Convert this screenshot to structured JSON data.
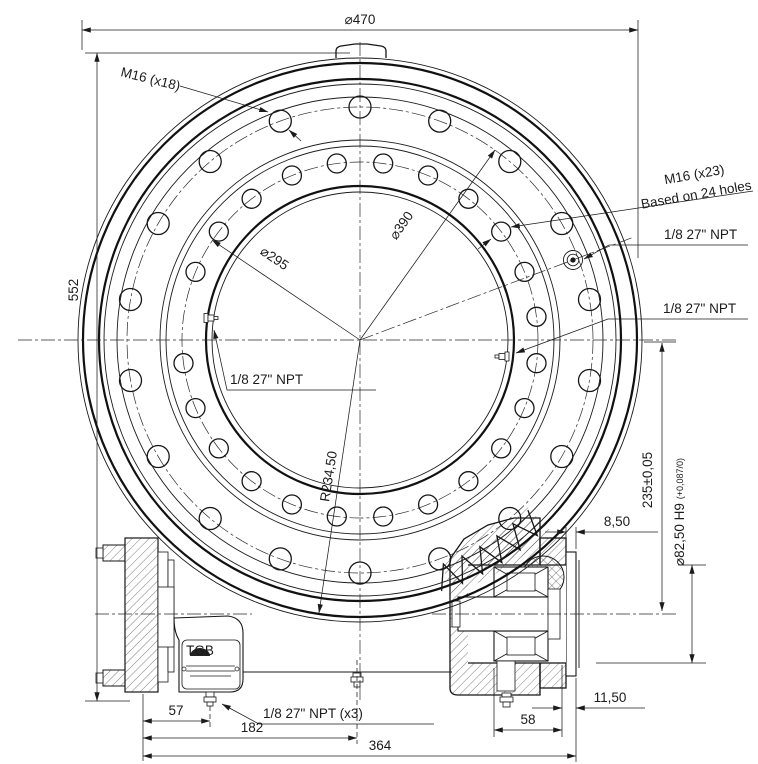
{
  "drawing": {
    "front_view": {
      "dim_outer_diameter": "⌀470",
      "dim_overall_height": "552",
      "dim_bolt_circle_outer": "⌀390",
      "dim_bolt_circle_inner": "⌀295",
      "dim_outer_radius": "R234,50",
      "label_outer_bolts": "M16 (x18)",
      "label_inner_bolts_line1": "M16 (x23)",
      "label_inner_bolts_line2": "Based on 24 holes",
      "label_npt_top_right": "1/8 27\" NPT",
      "label_npt_mid_right": "1/8 27\" NPT",
      "label_npt_left": "1/8 27\" NPT",
      "bolt_circles": [
        {
          "group": "outer-bolt-holes",
          "count": 18,
          "radius_px": 233,
          "hole_radius_px": 11,
          "start_deg": 90,
          "step_deg": 20,
          "skip_deg": []
        },
        {
          "group": "inner-bolt-holes",
          "count": 24,
          "radius_px": 178,
          "hole_radius_px": 9.5,
          "start_deg": 7.5,
          "step_deg": 15,
          "skip_deg": [
            172.5
          ]
        }
      ]
    },
    "section_view": {
      "dim_center_to_worm_axis": "235±0,05",
      "dim_cover_plate_thickness": "8,50",
      "dim_pilot_bore": "⌀82,50 H9",
      "dim_pilot_bore_tolerance": "(+0,087/0)",
      "dim_face_offset": "11,50",
      "dim_left_to_grease_port": "57",
      "dim_left_to_center": "182",
      "dim_overall_width": "364",
      "dim_bearing_span": "58",
      "label_npt_bottom": "1/8 27\" NPT (x3)",
      "nameplate_logo": "TGB"
    }
  }
}
